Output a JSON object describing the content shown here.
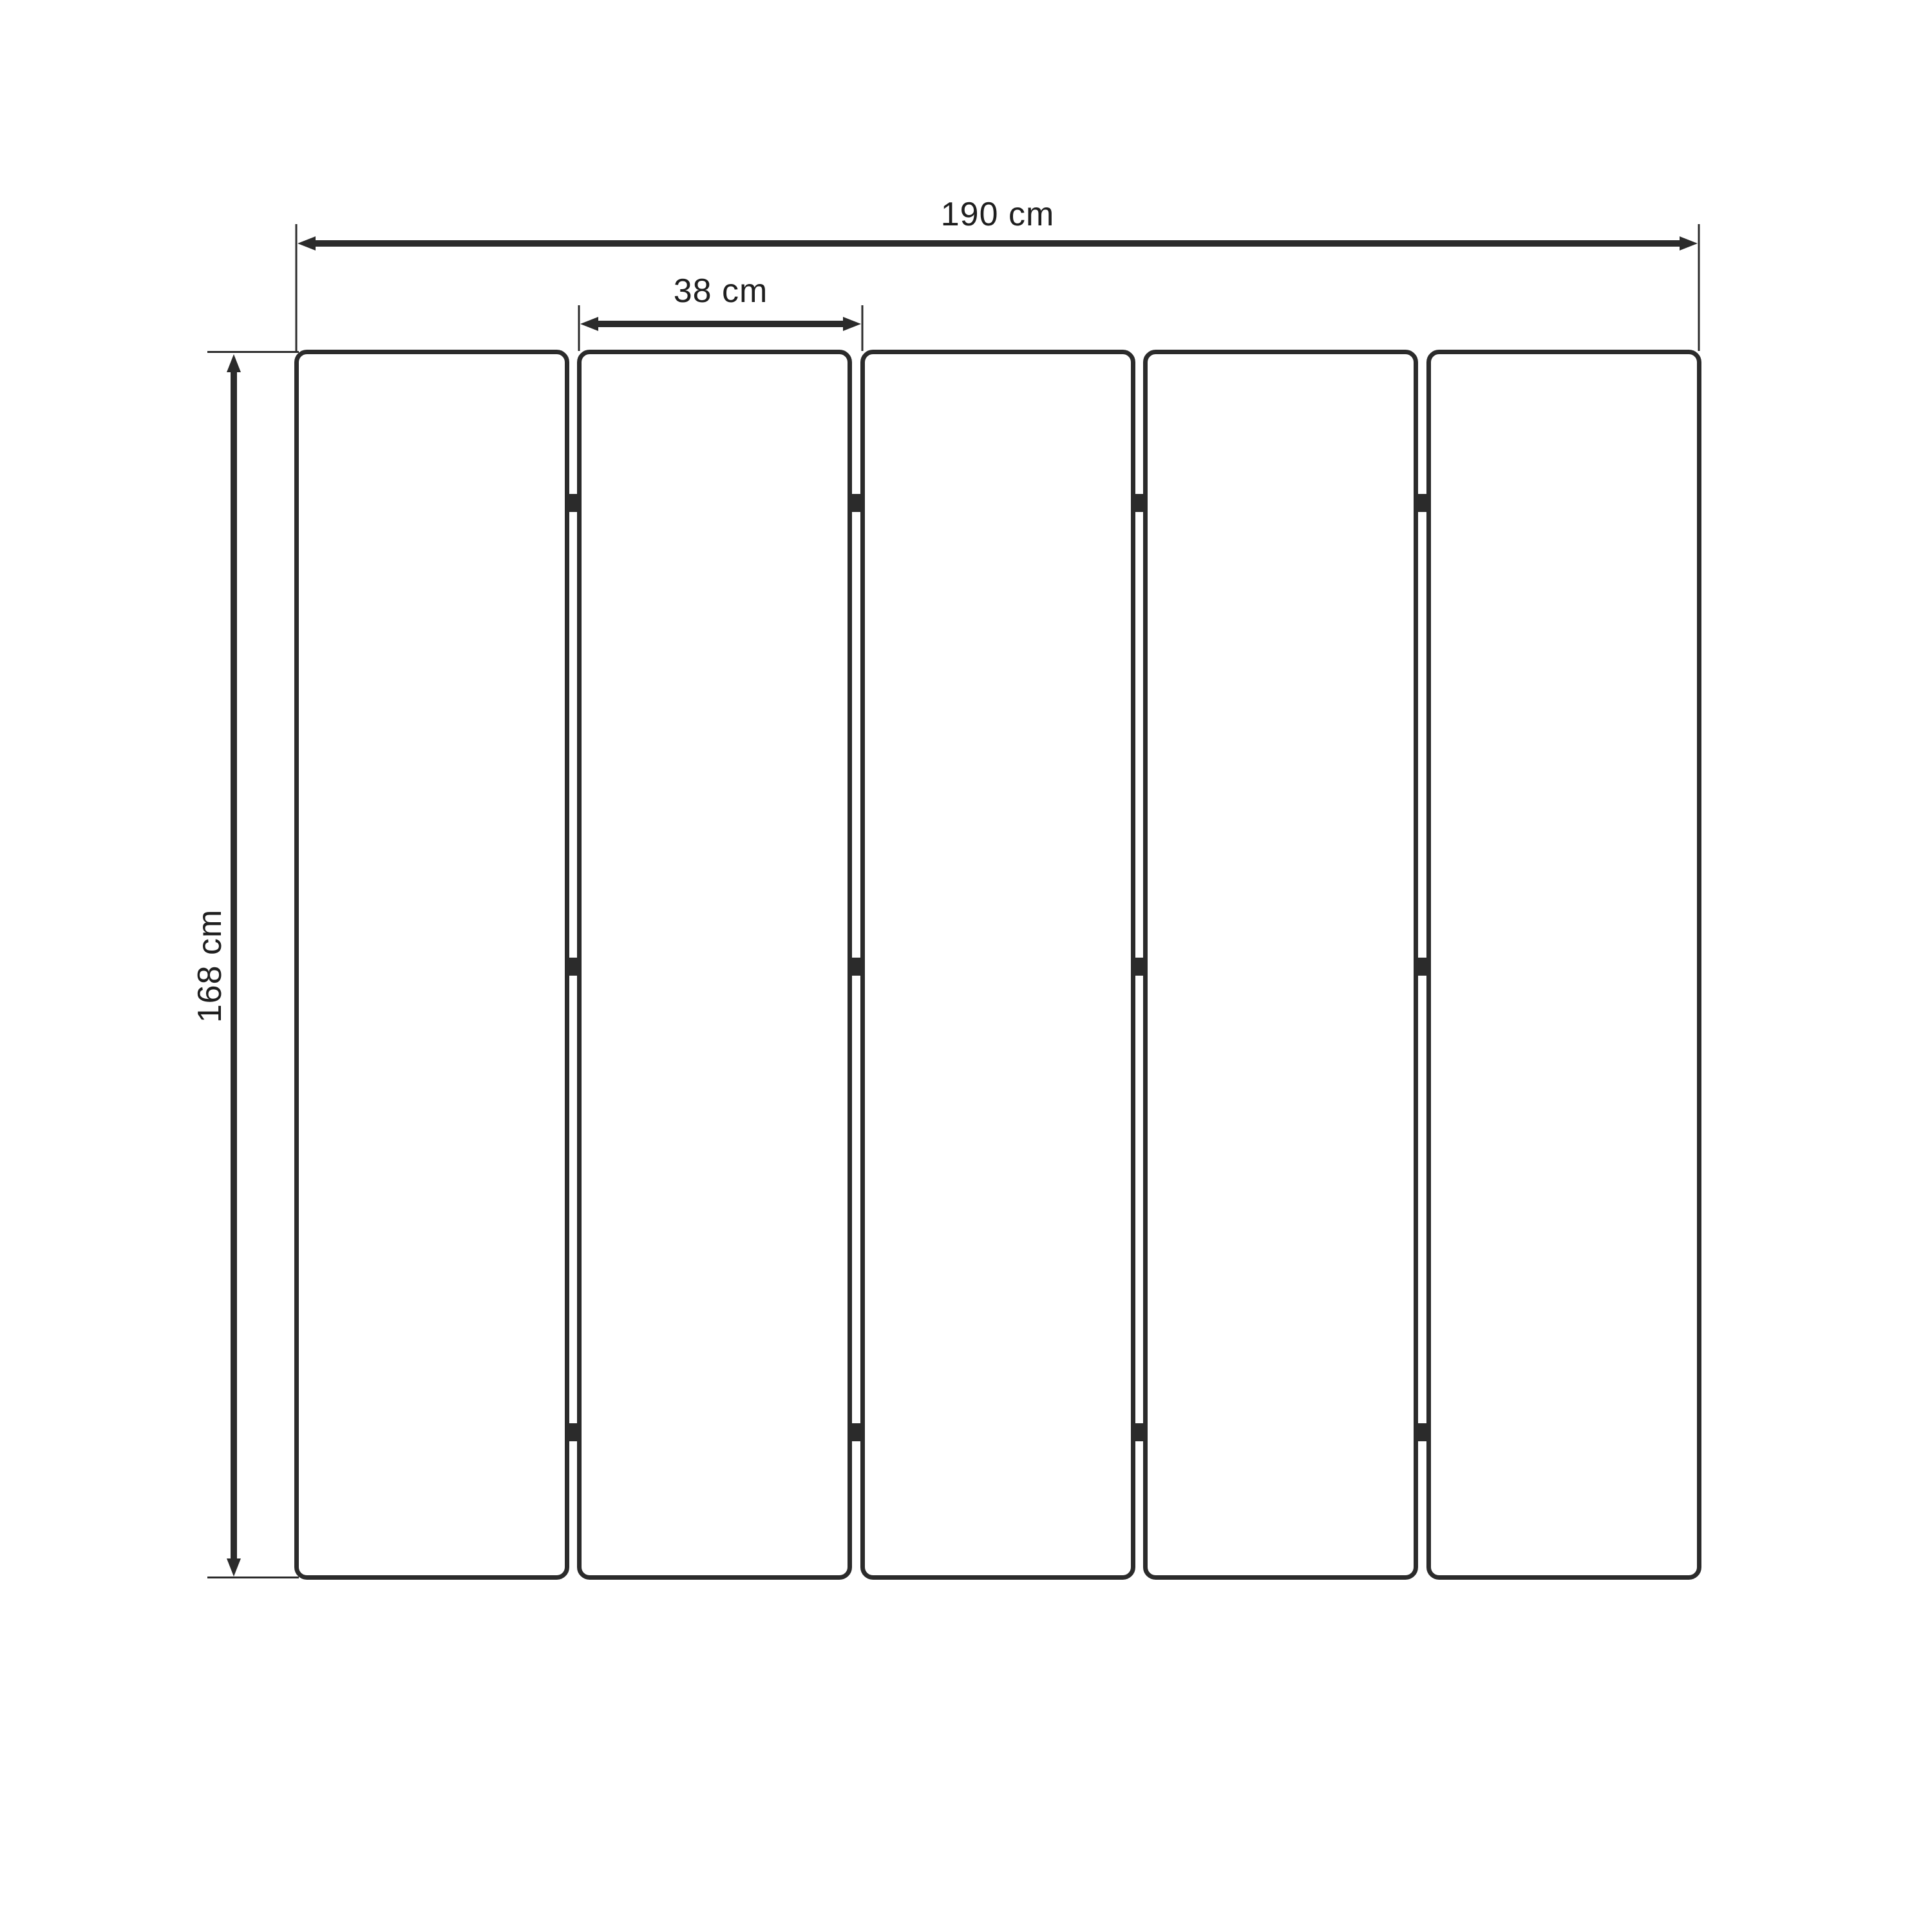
{
  "diagram": {
    "type": "technical-dimension-drawing",
    "subject": "five-panel-folding-screen-front-view",
    "panel_count": 5,
    "hinge_rows": 3,
    "dimensions": {
      "total_width": {
        "label": "190 cm",
        "value": 190,
        "unit": "cm"
      },
      "panel_width": {
        "label": "38 cm",
        "value": 38,
        "unit": "cm"
      },
      "height": {
        "label": "168 cm",
        "value": 168,
        "unit": "cm"
      }
    },
    "colors": {
      "stroke": "#2b2b2b",
      "text": "#1f1f1f",
      "background": "#ffffff"
    }
  }
}
